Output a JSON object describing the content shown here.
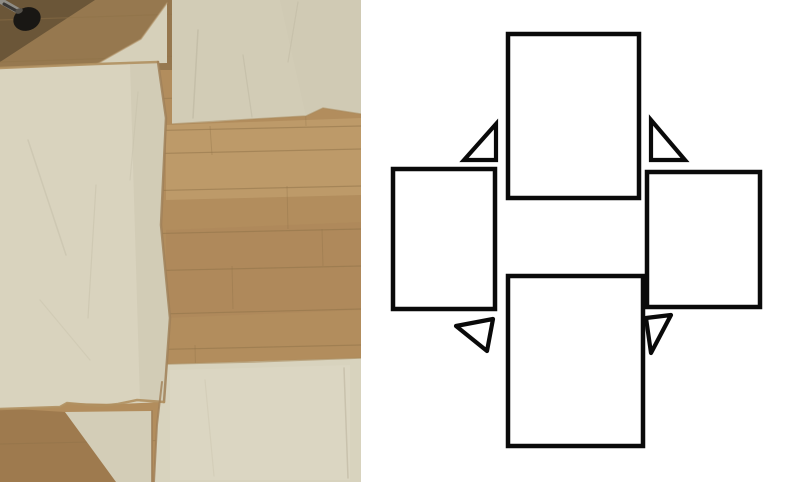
{
  "photo": {
    "width": 361,
    "height": 482,
    "colors": {
      "wood_base": "#b28d5d",
      "plank_line": "#8f7248"
    },
    "wood_shades": [
      {
        "name": "wood-dark-top-strip",
        "points": "0,0 172,0 172,70 0,70",
        "fill": "#7f6844",
        "opacity": 0.55
      },
      {
        "name": "wood-corner-shadow",
        "points": "0,0 95,0 0,62",
        "fill": "#4f3f29",
        "opacity": 0.6
      },
      {
        "name": "wood-light-mid-band",
        "points": "166,125 361,118 361,195 166,200",
        "fill": "#c8a876",
        "opacity": 0.5
      },
      {
        "name": "wood-mid-dark-band",
        "points": "166,230 361,222 361,310 166,318",
        "fill": "#a8835a",
        "opacity": 0.35
      },
      {
        "name": "wood-bottom-wedge",
        "points": "0,408 65,412 118,482 0,482",
        "fill": "#9a774b",
        "opacity": 0.85
      }
    ],
    "wood_planks": [
      [
        0,
        20,
        361,
        8,
        1.2,
        0.45
      ],
      [
        0,
        62,
        361,
        50,
        1.2,
        0.45
      ],
      [
        0,
        104,
        361,
        92,
        1.2,
        0.4
      ],
      [
        0,
        134,
        361,
        126,
        1.2,
        0.5
      ],
      [
        0,
        157,
        361,
        149,
        1.2,
        0.5
      ],
      [
        0,
        194,
        361,
        186,
        1.2,
        0.5
      ],
      [
        0,
        237,
        361,
        229,
        1.2,
        0.5
      ],
      [
        0,
        274,
        361,
        266,
        1.2,
        0.5
      ],
      [
        0,
        318,
        361,
        309,
        1.2,
        0.5
      ],
      [
        0,
        353,
        361,
        345,
        1.2,
        0.5
      ],
      [
        0,
        399,
        361,
        391,
        1.2,
        0.45
      ],
      [
        0,
        444,
        361,
        436,
        1.2,
        0.4
      ],
      [
        210,
        126,
        212,
        155,
        1,
        0.35
      ],
      [
        287,
        186,
        288,
        229,
        1,
        0.35
      ],
      [
        232,
        266,
        233,
        309,
        1,
        0.35
      ],
      [
        322,
        229,
        323,
        266,
        1,
        0.35
      ],
      [
        195,
        345,
        196,
        391,
        1,
        0.35
      ],
      [
        305,
        92,
        306,
        126,
        1,
        0.3
      ]
    ],
    "caster": {
      "stem": {
        "x1": 1,
        "y1": 1,
        "x2": 22,
        "y2": 13,
        "color": "#8f8d86",
        "width": 6
      },
      "stem_shadow": {
        "x1": 4,
        "y1": 4,
        "x2": 24,
        "y2": 15,
        "color": "#3a3835",
        "width": 3
      },
      "wheel": {
        "cx": 27,
        "cy": 19,
        "rx": 14,
        "ry": 11.5,
        "rotate": -22,
        "color": "#191714"
      },
      "highlight": {
        "cx": 19,
        "cy": 11,
        "rx": 4,
        "ry": 2.5,
        "rotate": -22,
        "color": "#55514a"
      }
    },
    "fabric_pieces": [
      {
        "name": "fabric-top-piece",
        "points": "172,0 361,0 361,114 323,108 306,116 254,119 213,122 172,124",
        "fill": "#d2ccb6",
        "opacity": 1
      },
      {
        "name": "fabric-top-flap",
        "points": "167,3 167,63 97,64 141,39",
        "fill": "#d6d0ba",
        "opacity": 1
      },
      {
        "name": "fabric-left-piece",
        "points": "0,68 97,64 158,62 166,118 161,225 170,318 164,402 118,404 67,403 60,407 0,409",
        "fill": "#d9d3be",
        "opacity": 1
      },
      {
        "name": "fabric-bottom-piece",
        "points": "167,364 361,358 361,482 154,482 157,425 162,382",
        "fill": "#d8d3be",
        "opacity": 1
      },
      {
        "name": "fabric-bottom-flap",
        "points": "65,412 152,411 152,482 116,482",
        "fill": "#d3cdb7",
        "opacity": 1
      },
      {
        "name": "fabric-shade-left-edge",
        "points": "130,63 158,62 166,118 161,225 170,318 164,402 140,402",
        "fill": "#c9c3ad",
        "opacity": 0.45
      },
      {
        "name": "fabric-shade-top-right",
        "points": "280,0 361,0 361,114 323,108 306,116",
        "fill": "#cdc7b1",
        "opacity": 0.5
      },
      {
        "name": "fabric-light-bottom",
        "points": "170,370 350,365 350,480 170,480",
        "fill": "#ded9c5",
        "opacity": 0.5
      }
    ],
    "seams": [
      {
        "points": "0,68 97,64 158,62",
        "color": "#b09061",
        "width": 2.5,
        "opacity": 0.9
      },
      {
        "points": "158,62 166,118 161,225 170,318 164,402",
        "color": "#a08058",
        "width": 2.5,
        "opacity": 0.85
      },
      {
        "points": "169,0 169,63",
        "color": "#96764c",
        "width": 3,
        "opacity": 0.9
      },
      {
        "points": "0,409 60,407 67,403 100,406 118,404 137,400 164,402",
        "color": "#b09061",
        "width": 2.5,
        "opacity": 0.9
      },
      {
        "points": "167,364 254,362 361,358",
        "color": "#a98a5c",
        "width": 1.5,
        "opacity": 0.6
      },
      {
        "points": "162,382 157,425 154,482",
        "color": "#a08058",
        "width": 2,
        "opacity": 0.8
      },
      {
        "points": "152,411 152,482",
        "color": "#a08058",
        "width": 2,
        "opacity": 0.8
      },
      {
        "points": "172,124 254,119 306,116 323,108 361,114",
        "color": "#a98a5c",
        "width": 1.5,
        "opacity": 0.55
      },
      {
        "points": "97,64 141,39 167,3",
        "color": "#b3946a",
        "width": 1.5,
        "opacity": 0.6
      }
    ],
    "wrinkles": [
      {
        "points": "198,30 193,118",
        "color": "#bcb6a0",
        "width": 1.5,
        "opacity": 0.6
      },
      {
        "points": "243,55 252,117",
        "color": "#bcb6a0",
        "width": 1.2,
        "opacity": 0.5
      },
      {
        "points": "298,2 288,62",
        "color": "#bcb6a0",
        "width": 1.2,
        "opacity": 0.45
      },
      {
        "points": "28,140 66,255",
        "color": "#c3bda7",
        "width": 1.5,
        "opacity": 0.5
      },
      {
        "points": "96,185 88,318",
        "color": "#c3bda7",
        "width": 1.2,
        "opacity": 0.45
      },
      {
        "points": "138,92 130,180",
        "color": "#c3bda7",
        "width": 1.2,
        "opacity": 0.4
      },
      {
        "points": "40,300 90,360",
        "color": "#c3bda7",
        "width": 1.2,
        "opacity": 0.35
      },
      {
        "points": "344,368 348,478",
        "color": "#b9b39d",
        "width": 1.5,
        "opacity": 0.55
      },
      {
        "points": "205,380 214,476",
        "color": "#c3bda7",
        "width": 1.2,
        "opacity": 0.3
      }
    ]
  },
  "diagram": {
    "stroke": "#0a0a0a",
    "fill": "#ffffff",
    "stroke_width": 4.5,
    "triangle_stroke_width": 4.2,
    "rects": [
      {
        "name": "diagram-rect-top",
        "x": 147,
        "y": 34,
        "w": 131,
        "h": 164
      },
      {
        "name": "diagram-rect-left",
        "x": 32,
        "y": 169,
        "w": 102,
        "h": 140
      },
      {
        "name": "diagram-rect-right",
        "x": 286,
        "y": 172,
        "w": 113,
        "h": 135
      },
      {
        "name": "diagram-rect-bottom",
        "x": 147,
        "y": 276,
        "w": 135,
        "h": 170
      }
    ],
    "triangles": [
      {
        "name": "diagram-triangle-upper-left",
        "points": "103,160 135,160 135,124",
        "join": "miter"
      },
      {
        "name": "diagram-triangle-upper-right",
        "points": "290,120 290,160 324,160",
        "join": "miter"
      },
      {
        "name": "diagram-triangle-lower-left",
        "points": "95,326 132,319 126,351",
        "join": "round"
      },
      {
        "name": "diagram-triangle-lower-right",
        "points": "285,318 310,315 290,353",
        "join": "round"
      }
    ]
  }
}
